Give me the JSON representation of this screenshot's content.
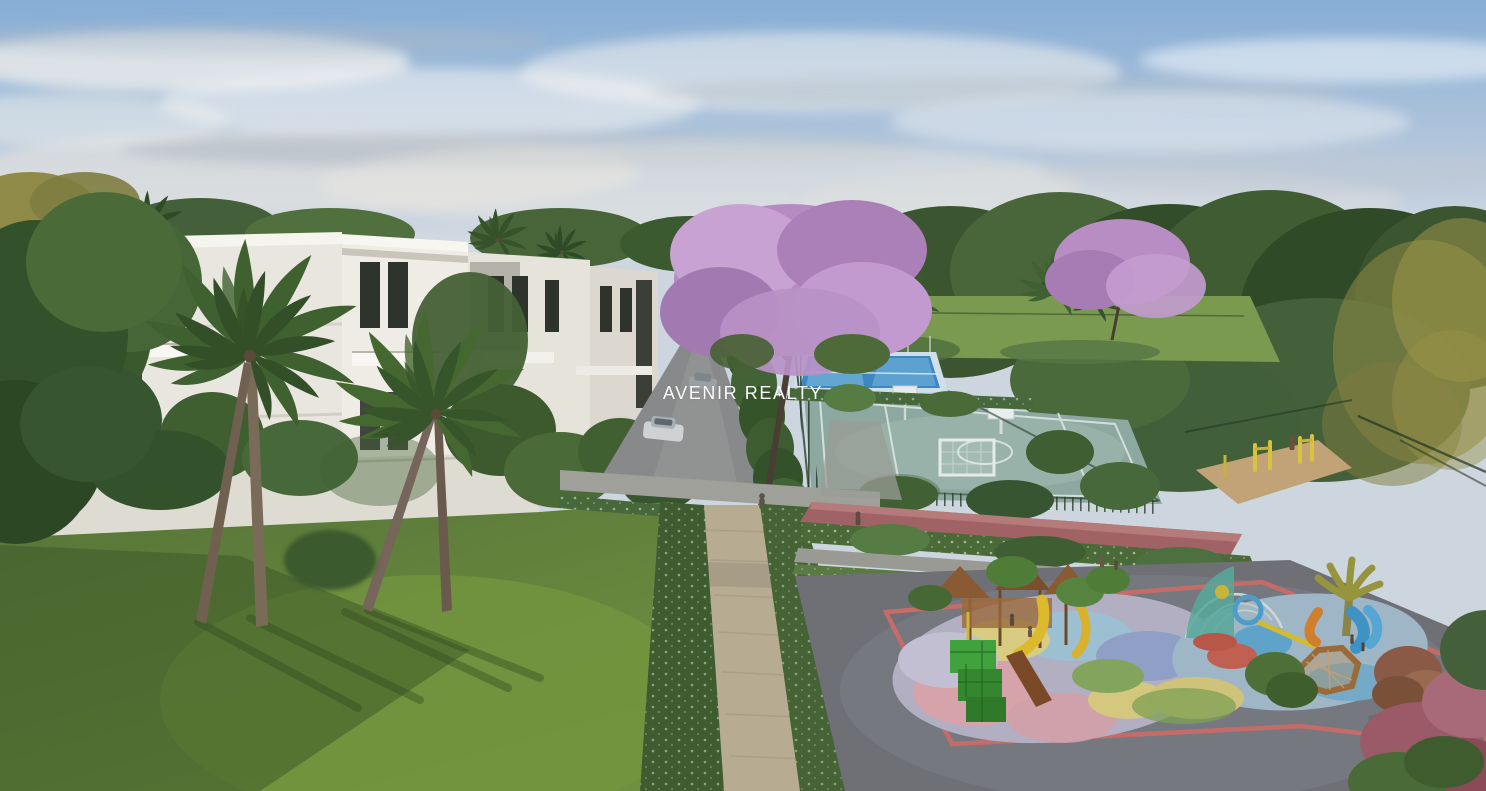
{
  "watermark": {
    "text": "AVENIR REALTY"
  },
  "palette": {
    "sky_top": "#86add5",
    "sky_horizon": "#d8dde2",
    "cloud": "#f2f0ec",
    "foliage_dark": "#33512a",
    "foliage_mid": "#4a6b38",
    "foliage_light": "#5f8344",
    "golden_tree": "#8f8a48",
    "jacaranda": "#b58bc2",
    "jacaranda_light": "#c8a2d2",
    "building_wall": "#e9e6df",
    "building_wall_bright": "#efece6",
    "building_shadow": "#d5d2ca",
    "window": "#2e332c",
    "road": "#87898a",
    "car_silver": "#cfd1d2",
    "path_stone": "#b7ac92",
    "lawn": "#64873c",
    "lawn_shadow": "#3a5526",
    "distant_lawn": "#7a9a50",
    "hedge": "#3e5c30",
    "palm": "#3f6130",
    "court_surface": "#8da8a1",
    "court_blue": "#3d87c2",
    "court_line": "#dfe8e4",
    "fence": "#1e3320",
    "track": "#a06264",
    "sand": "#c2a277",
    "equipment_yellow": "#d9c23c",
    "playground_asphalt": "#6e7075",
    "playground_border": "#cf6a66",
    "rubber_lavender": "#b2afc2",
    "rubber_pink": "#d7a3ab",
    "rubber_blue": "#9cc0d2",
    "rubber_yellow": "#d8cc82",
    "slide_yellow": "#ddb92e",
    "climber_green": "#3fa23c",
    "wood": "#8a5a34",
    "dome_teal": "#57a89a",
    "water_blue": "#4f9cca",
    "slide_blue": "#3f93c4",
    "slide_orange": "#cf7f2e"
  }
}
